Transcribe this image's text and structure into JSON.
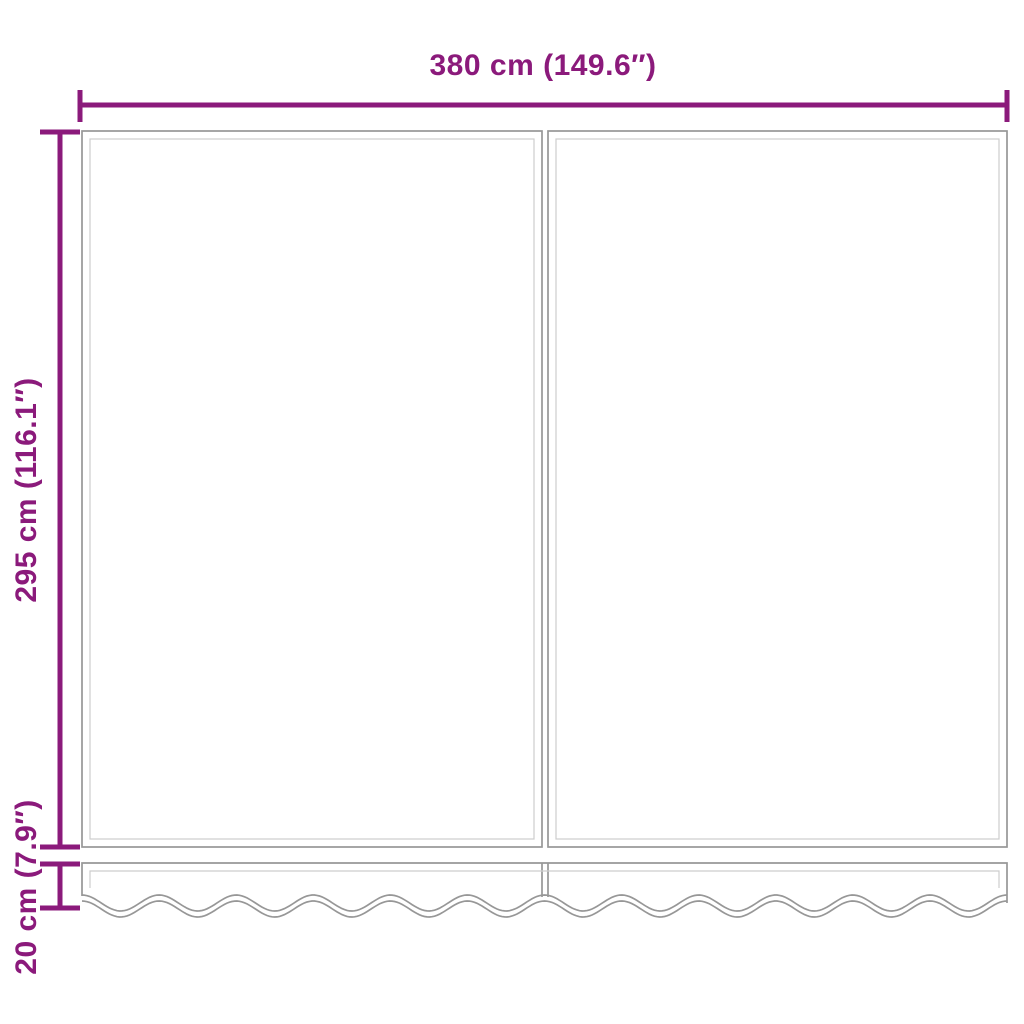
{
  "diagram": {
    "dimension_labels": {
      "width": "380 cm (149.6″)",
      "height": "295 cm (116.1″)",
      "valance": "20 cm (7.9″)"
    },
    "colors": {
      "dimension_lines": "#8B1A7B",
      "fabric_outline": "#979797",
      "fabric_hem": "#CDCDCD",
      "background": "#FFFFFF"
    }
  }
}
